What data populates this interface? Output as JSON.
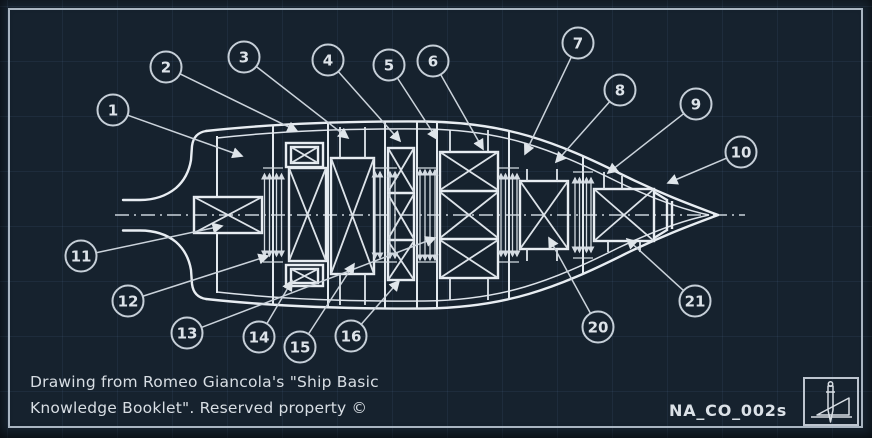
{
  "caption": {
    "line1": "Drawing from Romeo Giancola's \"Ship Basic",
    "line2": "Knowledge Booklet\". Reserved property ©"
  },
  "title_block": {
    "doc_number": "NA_CO_002s",
    "logo_icon": "drafting-compass-and-set-square"
  },
  "colors": {
    "background": "#16222e",
    "line": "#e8edf2",
    "muted_line": "#c9d1d9",
    "grid": "#3a536c",
    "frame": "#b6c2ce",
    "text": "#d8dee4"
  },
  "drawing": {
    "subject": "ship-general-arrangement-plan-view",
    "callouts": [
      {
        "n": "1",
        "cx": 113,
        "cy": 110,
        "tx": 242,
        "ty": 156
      },
      {
        "n": "2",
        "cx": 166,
        "cy": 67,
        "tx": 297,
        "ty": 131
      },
      {
        "n": "3",
        "cx": 244,
        "cy": 57,
        "tx": 348,
        "ty": 138
      },
      {
        "n": "4",
        "cx": 328,
        "cy": 60,
        "tx": 400,
        "ty": 141
      },
      {
        "n": "5",
        "cx": 389,
        "cy": 65,
        "tx": 437,
        "ty": 139
      },
      {
        "n": "6",
        "cx": 433,
        "cy": 61,
        "tx": 483,
        "ty": 149
      },
      {
        "n": "7",
        "cx": 578,
        "cy": 43,
        "tx": 525,
        "ty": 154
      },
      {
        "n": "8",
        "cx": 620,
        "cy": 90,
        "tx": 556,
        "ty": 162
      },
      {
        "n": "9",
        "cx": 696,
        "cy": 104,
        "tx": 608,
        "ty": 173
      },
      {
        "n": "10",
        "cx": 741,
        "cy": 152,
        "tx": 668,
        "ty": 183
      },
      {
        "n": "11",
        "cx": 81,
        "cy": 256,
        "tx": 222,
        "ty": 226
      },
      {
        "n": "12",
        "cx": 128,
        "cy": 301,
        "tx": 268,
        "ty": 256
      },
      {
        "n": "13",
        "cx": 187,
        "cy": 333,
        "tx": 435,
        "ty": 238
      },
      {
        "n": "14",
        "cx": 259,
        "cy": 337,
        "tx": 292,
        "ty": 281
      },
      {
        "n": "15",
        "cx": 300,
        "cy": 347,
        "tx": 354,
        "ty": 264
      },
      {
        "n": "16",
        "cx": 351,
        "cy": 336,
        "tx": 399,
        "ty": 281
      },
      {
        "n": "20",
        "cx": 598,
        "cy": 327,
        "tx": 549,
        "ty": 238
      },
      {
        "n": "21",
        "cx": 695,
        "cy": 301,
        "tx": 627,
        "ty": 239
      }
    ]
  }
}
